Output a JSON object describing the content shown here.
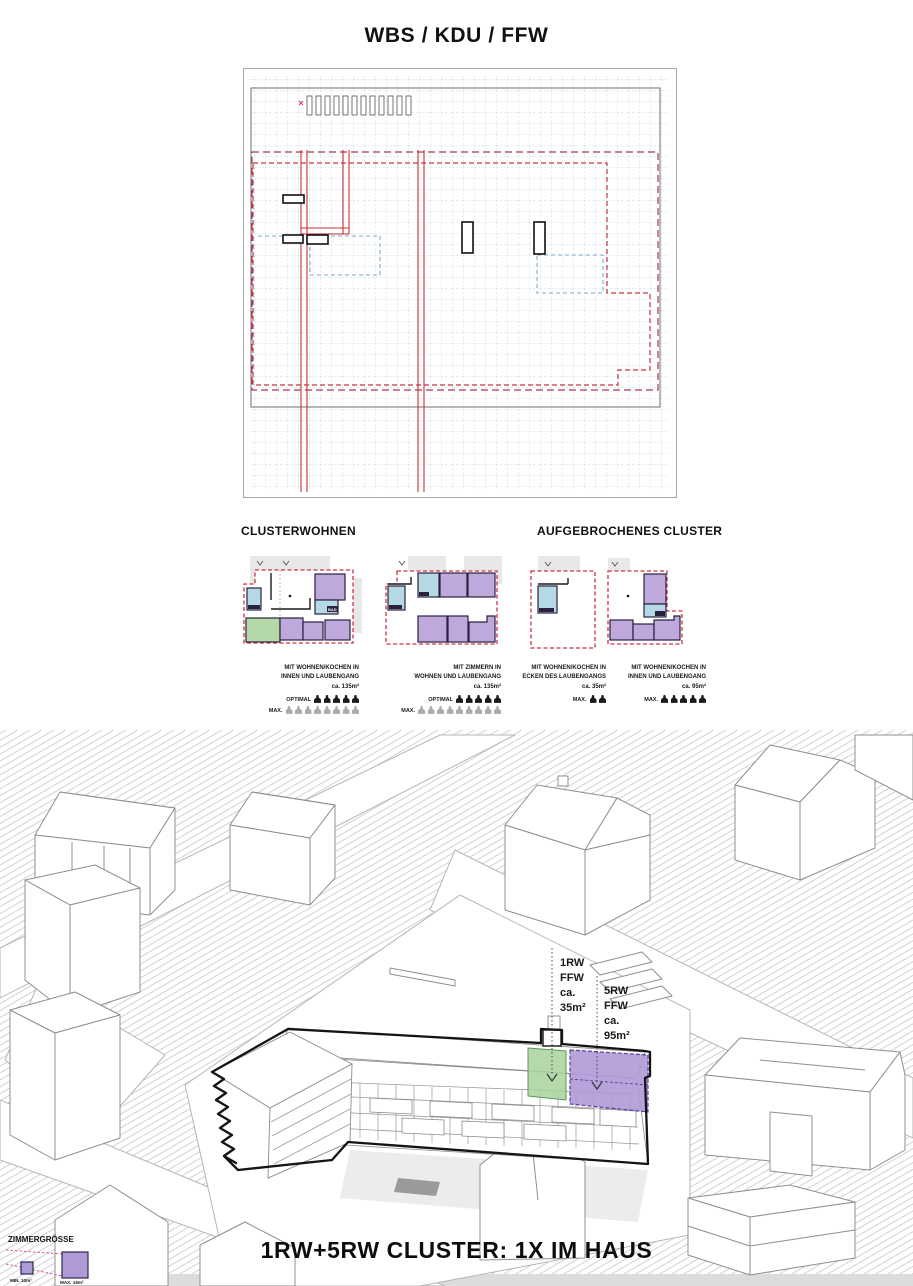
{
  "title": "WBS / KDU / FFW",
  "sections": {
    "left_heading": "CLUSTERWOHNEN",
    "right_heading": "AUFGEBROCHENES CLUSTER"
  },
  "bad_label": "BAD",
  "clusters": [
    {
      "caption": [
        "MIT WOHNEN/KOCHEN IN",
        "INNEN UND LAUBENGANG",
        "ca. 135m²"
      ],
      "rows": [
        {
          "label": "OPTIMAL",
          "count": 5,
          "style": "dark"
        },
        {
          "label": "MAX.",
          "count": 8,
          "style": "gray"
        }
      ]
    },
    {
      "caption": [
        "MIT ZIMMERN IN",
        "WOHNEN UND LAUBENGANG",
        "ca. 135m²"
      ],
      "rows": [
        {
          "label": "OPTIMAL",
          "count": 5,
          "style": "dark"
        },
        {
          "label": "MAX.",
          "count": 9,
          "style": "gray"
        }
      ]
    },
    {
      "caption": [
        "MIT WOHNEN/KOCHEN IN",
        "ECKEN DES LAUBENGANGS",
        "ca. 35m²"
      ],
      "rows": [
        {
          "label": "MAX.",
          "count": 2,
          "style": "dark"
        }
      ]
    },
    {
      "caption": [
        "MIT WOHNEN/KOCHEN IN",
        "INNEN UND LAUBENGANG",
        "ca. 95m²"
      ],
      "rows": [
        {
          "label": "MAX.",
          "count": 5,
          "style": "dark"
        }
      ]
    }
  ],
  "scene": {
    "annotation_1": {
      "l1": "1RW",
      "l2": "FFW",
      "l3": "ca.",
      "l4": "35m²"
    },
    "annotation_2": {
      "l1": "5RW",
      "l2": "FFW",
      "l3": "ca.",
      "l4": "95m²"
    },
    "legend": {
      "title": "ZIMMERGRÖSSE",
      "min": "MIN. 10m²",
      "max": "MAX. 16m²"
    },
    "footer": "1RW+5RW CLUSTER: 1X IM HAUS"
  },
  "colors": {
    "plan_red": "#cc3344",
    "plan_maroon": "#a53b50",
    "grid_blue": "#b7d3dc",
    "dash_blue": "#7fa8cc",
    "room_purple": "#bfa8dc",
    "room_green": "#b4d8a8",
    "room_lightblue": "#b6d9e6",
    "accent_purple_dark": "#5b3f96",
    "accent_green_dark": "#5a9a55"
  }
}
